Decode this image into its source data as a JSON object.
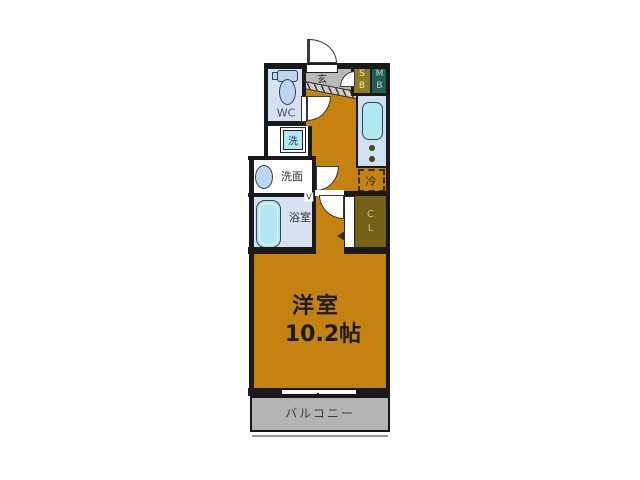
{
  "floorplan": {
    "main_room": {
      "name": "洋室",
      "size": "10.2帖"
    },
    "balcony": {
      "label": "バルコニー"
    },
    "toilet": {
      "label": "WC"
    },
    "washer": {
      "label": "洗"
    },
    "washroom": {
      "label": "洗面"
    },
    "bathroom": {
      "label": "浴室",
      "door_mark": "V"
    },
    "entrance": {
      "label": "玄"
    },
    "shoe_box": {
      "line1": "S",
      "line2": "B"
    },
    "meter_box": {
      "line1": "M",
      "line2": "B"
    },
    "refrigerator": {
      "label": "冷"
    },
    "closet": {
      "line1": "C",
      "line2": "L"
    },
    "colors": {
      "room_fill": "#c4830e",
      "wall": "#1a1a1a",
      "entrance_fill": "#b9b9b9",
      "shoe_box_fill": "#8f7c1e",
      "meter_box_fill": "#215e54",
      "closet_fill": "#756113",
      "wet_room_fill": "#d6e2f2",
      "kitchen_fill": "#cfe0f2",
      "fixture_fill": "#b2e8f2",
      "porcelain_fill": "#bcd6f2",
      "balcony_fill": "#b4b4b4"
    }
  }
}
